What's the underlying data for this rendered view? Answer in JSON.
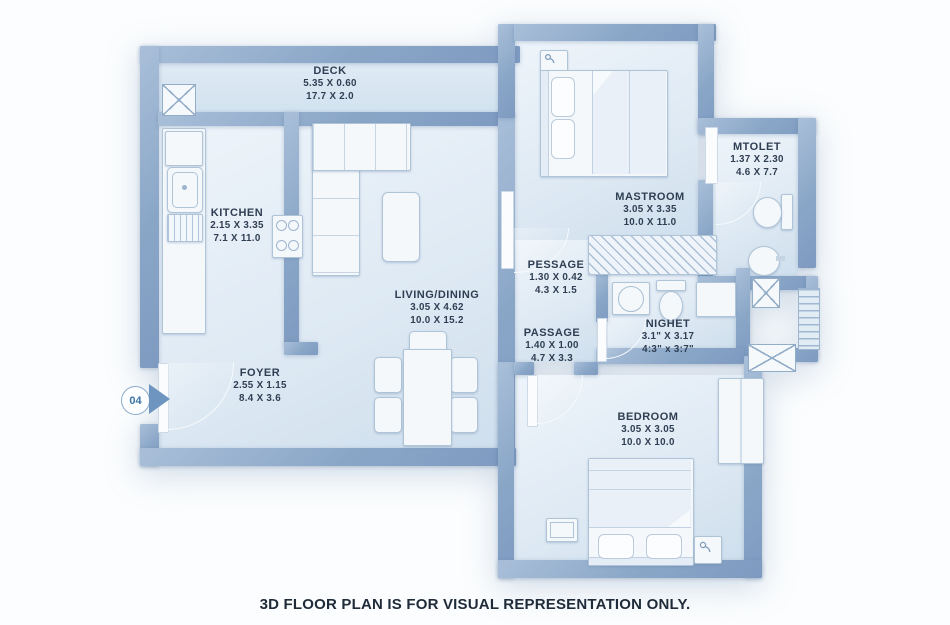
{
  "caption": "3D FLOOR PLAN IS FOR VISUAL REPRESENTATION ONLY.",
  "unit_marker": "04",
  "rooms": {
    "deck": {
      "name": "DECK",
      "metric": "5.35 X 0.60",
      "imperial": "17.7 X 2.0"
    },
    "kitchen": {
      "name": "KITCHEN",
      "metric": "2.15 X 3.35",
      "imperial": "7.1 X 11.0"
    },
    "living_dining": {
      "name": "LIVING/DINING",
      "metric": "3.05 X 4.62",
      "imperial": "10.0 X 15.2"
    },
    "foyer": {
      "name": "FOYER",
      "metric": "2.55 X 1.15",
      "imperial": "8.4 X 3.6"
    },
    "mastroom": {
      "name": "MASTROOM",
      "metric": "3.05 X 3.35",
      "imperial": "10.0 X 11.0"
    },
    "mtolet": {
      "name": "MTOLET",
      "metric": "1.37 X 2.30",
      "imperial": "4.6 X 7.7"
    },
    "pessage": {
      "name": "PESSAGE",
      "metric": "1.30 X 0.42",
      "imperial": "4.3 X 1.5"
    },
    "passage": {
      "name": "PASSAGE",
      "metric": "1.40 X 1.00",
      "imperial": "4.7 X 3.3"
    },
    "nighet": {
      "name": "NIGHET",
      "metric": "3.1\" X 3.17",
      "imperial": "4:3\" x 3:7\""
    },
    "bedroom": {
      "name": "BEDROOM",
      "metric": "3.05 X 3.05",
      "imperial": "10.0 X 10.0"
    }
  },
  "colors": {
    "wall": "#8aa6c7",
    "floor": "#e3edf6",
    "text": "#2f3e52",
    "accent": "#3c74a6"
  }
}
